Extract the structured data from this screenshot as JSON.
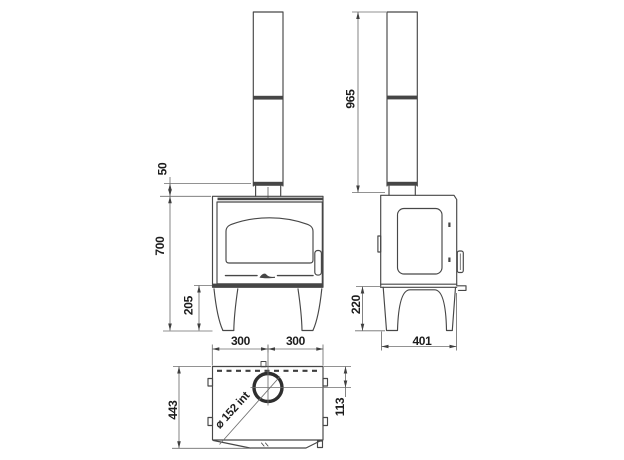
{
  "drawing": {
    "front_view": {
      "dim_collar": "50",
      "dim_height": "700",
      "dim_legs": "205",
      "dim_width_left": "300",
      "dim_width_right": "300"
    },
    "side_view": {
      "dim_flue_height": "965",
      "dim_legs": "220",
      "dim_depth": "401"
    },
    "top_view": {
      "dim_depth": "443",
      "dim_flue_offset": "113",
      "flue_diameter_label": "⌀ 152 int"
    },
    "colors": {
      "line": "#474747",
      "dim_line": "#6e6e6e",
      "text": "#1c1c1c",
      "band": "#464646",
      "background": "#ffffff"
    }
  }
}
